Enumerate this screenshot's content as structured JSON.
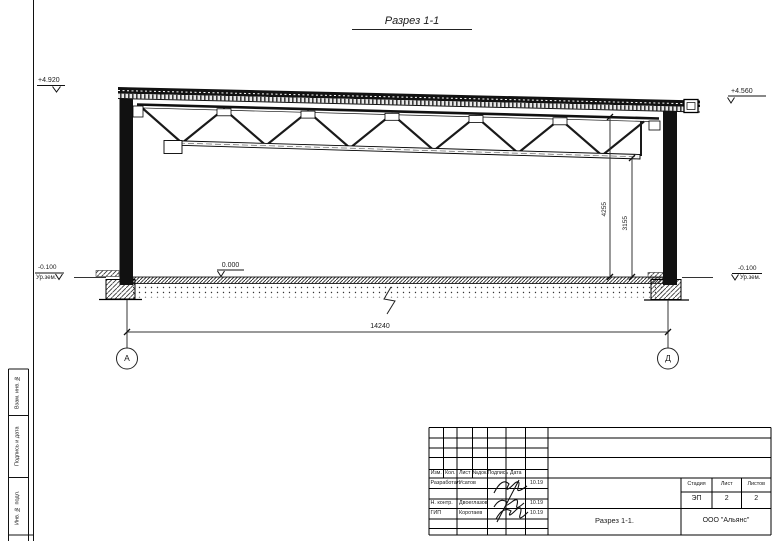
{
  "title": "Разрез 1-1",
  "drawing": {
    "levels": {
      "top_left": "+4.920",
      "top_right": "+4.560",
      "floor": "0.000",
      "ground_left": "-0.100",
      "ground_left_label": "Ур.зем.",
      "ground_right": "-0.100",
      "ground_right_label": "Ур.зем."
    },
    "dimensions": {
      "to_truss_top": "4255",
      "to_truss_bottom": "3155",
      "span": "14240"
    },
    "axes": {
      "left": "А",
      "right": "Д"
    }
  },
  "sidebar": {
    "fields": [
      "Взам. инв. №",
      "Подпись и дата",
      "Инв. № подл."
    ]
  },
  "titleblock": {
    "headers": [
      "Изм.",
      "Кол.",
      "Лист",
      "№док.",
      "Подпись",
      "Дата"
    ],
    "rows": [
      {
        "role": "Разработал",
        "name": "Усатов",
        "date": "10.19"
      },
      {
        "role": "Н. контр.",
        "name": "Двоеглазов",
        "date": "10.19"
      },
      {
        "role": "ГИП",
        "name": "Коротаев",
        "date": "10.19"
      }
    ],
    "stage_label": "Стадия",
    "sheet_label": "Лист",
    "sheets_label": "Листов",
    "stage": "ЭП",
    "sheet": "2",
    "sheets": "2",
    "doc_name": "Разрез 1-1.",
    "company": "ООО \"Альянс\""
  }
}
